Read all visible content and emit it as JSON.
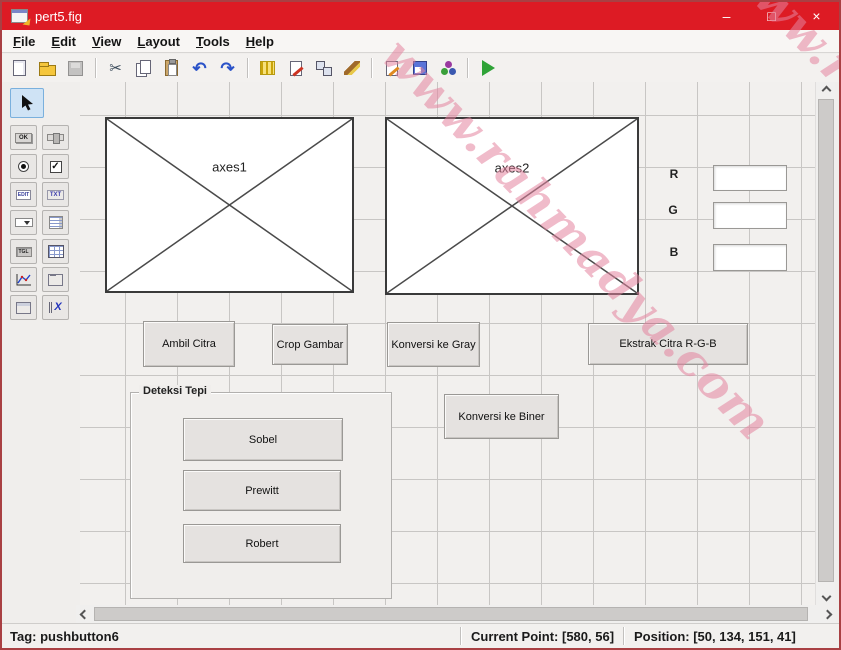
{
  "window": {
    "title": "pert5.fig",
    "minimize": "–",
    "maximize": "□",
    "close": "×"
  },
  "menu": {
    "items": [
      {
        "label": "File"
      },
      {
        "label": "Edit"
      },
      {
        "label": "View"
      },
      {
        "label": "Layout"
      },
      {
        "label": "Tools"
      },
      {
        "label": "Help"
      }
    ]
  },
  "toolbar": {
    "cut_glyph": "✂",
    "undo_glyph": "↶",
    "redo_glyph": "↷",
    "icons": [
      "new",
      "open",
      "save",
      "cut",
      "copy",
      "paste",
      "undo",
      "redo",
      "align-objects",
      "menu-editor",
      "tab-order-editor",
      "toolbar-editor",
      "editor",
      "property-inspector",
      "object-browser",
      "run"
    ]
  },
  "palette": {
    "tools": [
      {
        "name": "select"
      },
      {
        "name": "push-button",
        "glyph": "OK"
      },
      {
        "name": "slider"
      },
      {
        "name": "radio-button"
      },
      {
        "name": "check-box",
        "glyph": "✓"
      },
      {
        "name": "edit-text",
        "glyph": "EDIT"
      },
      {
        "name": "static-text",
        "glyph": "TXT"
      },
      {
        "name": "popup-menu"
      },
      {
        "name": "listbox"
      },
      {
        "name": "toggle-button",
        "glyph": "TGL"
      },
      {
        "name": "table"
      },
      {
        "name": "axes"
      },
      {
        "name": "panel"
      },
      {
        "name": "button-group"
      },
      {
        "name": "activex",
        "glyph": "X"
      }
    ]
  },
  "canvas": {
    "axes": [
      {
        "label": "axes1"
      },
      {
        "label": "axes2"
      }
    ],
    "rgb": {
      "r": "R",
      "g": "G",
      "b": "B"
    },
    "buttons": [
      {
        "label": "Ambil Citra"
      },
      {
        "label": "Crop Gambar"
      },
      {
        "label": "Konversi ke Gray"
      },
      {
        "label": "Ekstrak Citra R-G-B"
      },
      {
        "label": "Konversi ke Biner"
      }
    ],
    "edge_panel": {
      "title": "Deteksi Tepi",
      "buttons": [
        {
          "label": "Sobel",
          "selected": true
        },
        {
          "label": "Prewitt",
          "selected": false
        },
        {
          "label": "Robert",
          "selected": false
        }
      ]
    },
    "watermark": "www.rahmadya.com"
  },
  "statusbar": {
    "tag": "Tag: pushbutton6",
    "current_point": "Current Point: [580, 56]",
    "position": "Position: [50, 134, 151, 41]"
  },
  "colors": {
    "titlebar": "#dd1b24",
    "watermark": "#e484a0",
    "grid": "#c8c6c4",
    "selection": "#cfe3f5"
  }
}
